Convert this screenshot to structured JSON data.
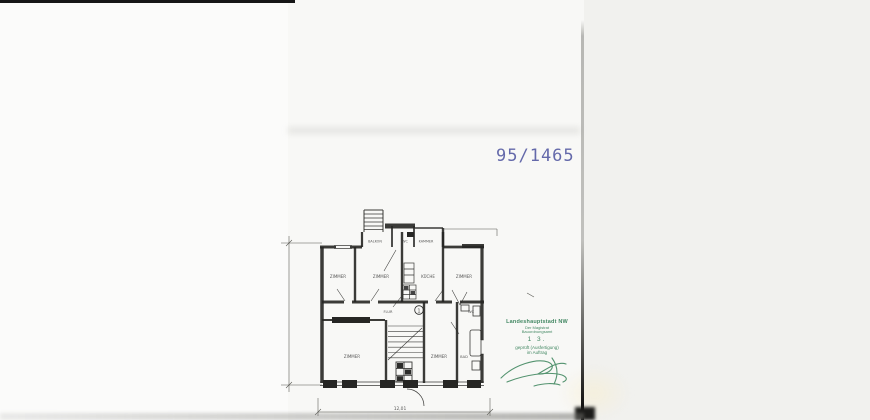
{
  "stamps": {
    "file_number": {
      "text": "95/1465",
      "color": "#5056a0"
    },
    "approval": {
      "color": "#2e7b52",
      "line1": "Landeshauptstadt NW",
      "line2": "Der Magistrat",
      "line3": "Bauordnungsamt",
      "date_line": "1 3.",
      "line5": "geprüft (Ausfertigung)",
      "line6": "im Auftrag"
    }
  },
  "floor_plan": {
    "ink_color": "#262624",
    "rooms": {
      "room_upper_left": "ZIMMER",
      "room_upper_mid": "ZIMMER",
      "kitchen": "KÜCHE",
      "room_upper_right": "ZIMMER",
      "balcony": "BALKON",
      "wc_top": "WC",
      "chamber": "KAMMER",
      "hall": "FLUR",
      "stair_number": "1",
      "wc_mid": "WC",
      "room_lower_left": "ZIMMER",
      "room_lower_mid": "ZIMMER",
      "bath": "BAD"
    },
    "dimension_label": "12,01"
  }
}
